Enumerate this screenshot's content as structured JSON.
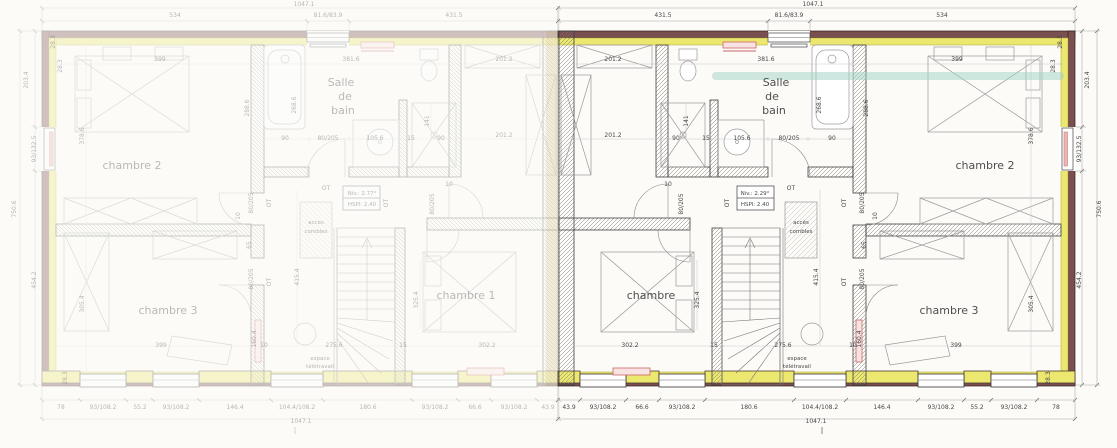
{
  "document": {
    "type": "architectural-floor-plan",
    "plans": [
      {
        "id": "left-plan",
        "style": "ghosted-mirror"
      },
      {
        "id": "right-plan",
        "style": "active"
      }
    ],
    "colors": {
      "wall": "#7a4f4f",
      "insulation_yellow": "#ece76f",
      "red_accent": "#cc6666",
      "teal_highlight": "#9ed2c4",
      "ink": "#474747",
      "background": "#fcfbf8"
    }
  },
  "rooms_right_plan": [
    "Salle de bain",
    "chambre",
    "chambre 2",
    "chambre 3"
  ],
  "rooms_left_plan": [
    "Salle de bain",
    "chambre 1",
    "chambre 2",
    "chambre 3"
  ],
  "labels": [
    {
      "t": "1047.1",
      "x": 813,
      "y": 6
    },
    {
      "t": "431.5",
      "x": 663,
      "y": 17
    },
    {
      "t": "81.6/83.9",
      "x": 789,
      "y": 17
    },
    {
      "t": "534",
      "x": 942,
      "y": 17
    },
    {
      "t": "43.9",
      "x": 569,
      "y": 409
    },
    {
      "t": "93/108.2",
      "x": 603,
      "y": 409
    },
    {
      "t": "66.6",
      "x": 642,
      "y": 409
    },
    {
      "t": "93/108.2",
      "x": 682,
      "y": 409
    },
    {
      "t": "180.6",
      "x": 749,
      "y": 409
    },
    {
      "t": "104.4/108.2",
      "x": 820,
      "y": 409
    },
    {
      "t": "146.4",
      "x": 882,
      "y": 409
    },
    {
      "t": "93/108.2",
      "x": 941,
      "y": 409
    },
    {
      "t": "55.2",
      "x": 977,
      "y": 409
    },
    {
      "t": "93/108.2",
      "x": 1014,
      "y": 409
    },
    {
      "t": "78",
      "x": 1056,
      "y": 409
    },
    {
      "t": "1047.1",
      "x": 816,
      "y": 423
    },
    {
      "t": "203.4",
      "x": 1089,
      "y": 80,
      "r": 1
    },
    {
      "t": "93/132.5",
      "x": 1081,
      "y": 149,
      "r": 1
    },
    {
      "t": "454.2",
      "x": 1081,
      "y": 280,
      "r": 1
    },
    {
      "t": "750.6",
      "x": 1101,
      "y": 209,
      "r": 1
    },
    {
      "t": "28.3",
      "x": 1062,
      "y": 42,
      "r": 1,
      "s": 5
    },
    {
      "t": "28.3",
      "x": 1055,
      "y": 66,
      "r": 1,
      "s": 5
    },
    {
      "t": "28.3",
      "x": 1050,
      "y": 378,
      "r": 1,
      "s": 5
    },
    {
      "t": "201.2",
      "x": 613,
      "y": 61
    },
    {
      "t": "381.6",
      "x": 766,
      "y": 61
    },
    {
      "t": "399",
      "x": 957,
      "y": 61
    },
    {
      "t": "201.2",
      "x": 613,
      "y": 137
    },
    {
      "t": "378.6",
      "x": 1033,
      "y": 136,
      "r": 1,
      "s": 5.5
    },
    {
      "t": "141",
      "x": 688,
      "y": 121,
      "r": 1,
      "s": 5
    },
    {
      "t": "90",
      "x": 676,
      "y": 140,
      "s": 5
    },
    {
      "t": "15",
      "x": 706,
      "y": 140,
      "s": 5
    },
    {
      "t": "105.6",
      "x": 742,
      "y": 140,
      "s": 5.5
    },
    {
      "t": "80/205",
      "x": 789,
      "y": 140,
      "s": 5.5
    },
    {
      "t": "90",
      "x": 832,
      "y": 140,
      "s": 5.5
    },
    {
      "t": "268.6",
      "x": 821,
      "y": 105,
      "r": 1,
      "s": 5.5
    },
    {
      "t": "288.6",
      "x": 868,
      "y": 108,
      "r": 1,
      "s": 5.5
    },
    {
      "t": "10",
      "x": 668,
      "y": 186,
      "s": 5
    },
    {
      "t": "80/205",
      "x": 683,
      "y": 204,
      "r": 1,
      "s": 5.5
    },
    {
      "t": "OT",
      "x": 729,
      "y": 203,
      "r": 1,
      "s": 7
    },
    {
      "t": "OT",
      "x": 791,
      "y": 190,
      "s": 7
    },
    {
      "t": "OT",
      "x": 846,
      "y": 203,
      "r": 1,
      "s": 7
    },
    {
      "t": "OT",
      "x": 846,
      "y": 282,
      "r": 1,
      "s": 7
    },
    {
      "t": "80/205",
      "x": 864,
      "y": 203,
      "r": 1,
      "s": 5.5
    },
    {
      "t": "10",
      "x": 877,
      "y": 216,
      "r": 1,
      "s": 5
    },
    {
      "t": "65",
      "x": 866,
      "y": 245,
      "r": 1,
      "s": 5.5
    },
    {
      "t": "80/205",
      "x": 864,
      "y": 279,
      "r": 1,
      "s": 5.5
    },
    {
      "t": "160.4",
      "x": 861,
      "y": 339,
      "r": 1,
      "s": 5.5
    },
    {
      "t": "415.4",
      "x": 818,
      "y": 277,
      "r": 1,
      "s": 5.5
    },
    {
      "t": "325.4",
      "x": 699,
      "y": 300,
      "r": 1,
      "s": 5.5
    },
    {
      "t": "305.4",
      "x": 1033,
      "y": 304,
      "r": 1,
      "s": 5.5
    },
    {
      "t": "302.2",
      "x": 630,
      "y": 347
    },
    {
      "t": "15",
      "x": 714,
      "y": 347,
      "s": 5
    },
    {
      "t": "275.6",
      "x": 783,
      "y": 347
    },
    {
      "t": "10",
      "x": 853,
      "y": 347,
      "s": 5
    },
    {
      "t": "399",
      "x": 956,
      "y": 347
    },
    {
      "t": "Niv.: 2.29°",
      "x": 755,
      "y": 195,
      "s": 5.5,
      "cls": "anno",
      "lt": "Niv.: 2.77°"
    },
    {
      "t": "HSPl: 2.40",
      "x": 755,
      "y": 206,
      "s": 5.5,
      "cls": "anno"
    },
    {
      "t": "accès",
      "x": 801,
      "y": 224,
      "s": 5,
      "cls": "anno"
    },
    {
      "t": "combles",
      "x": 801,
      "y": 233,
      "s": 5,
      "cls": "anno"
    },
    {
      "t": "espace",
      "x": 797,
      "y": 360,
      "s": 5,
      "cls": "anno"
    },
    {
      "t": "télétravail",
      "x": 797,
      "y": 368,
      "s": 5,
      "cls": "anno"
    },
    {
      "t": "chambre",
      "x": 651,
      "y": 299,
      "cls": "room",
      "lt": "chambre 1"
    },
    {
      "t": "chambre 2",
      "x": 985,
      "y": 169,
      "cls": "room"
    },
    {
      "t": "chambre 3",
      "x": 949,
      "y": 314,
      "cls": "room"
    },
    {
      "t": "Salle",
      "x": 776,
      "y": 86,
      "cls": "room",
      "s": 10
    },
    {
      "t": "de",
      "x": 772,
      "y": 100,
      "cls": "room",
      "s": 10
    },
    {
      "t": "bain",
      "x": 774,
      "y": 114,
      "cls": "room",
      "s": 10
    }
  ]
}
